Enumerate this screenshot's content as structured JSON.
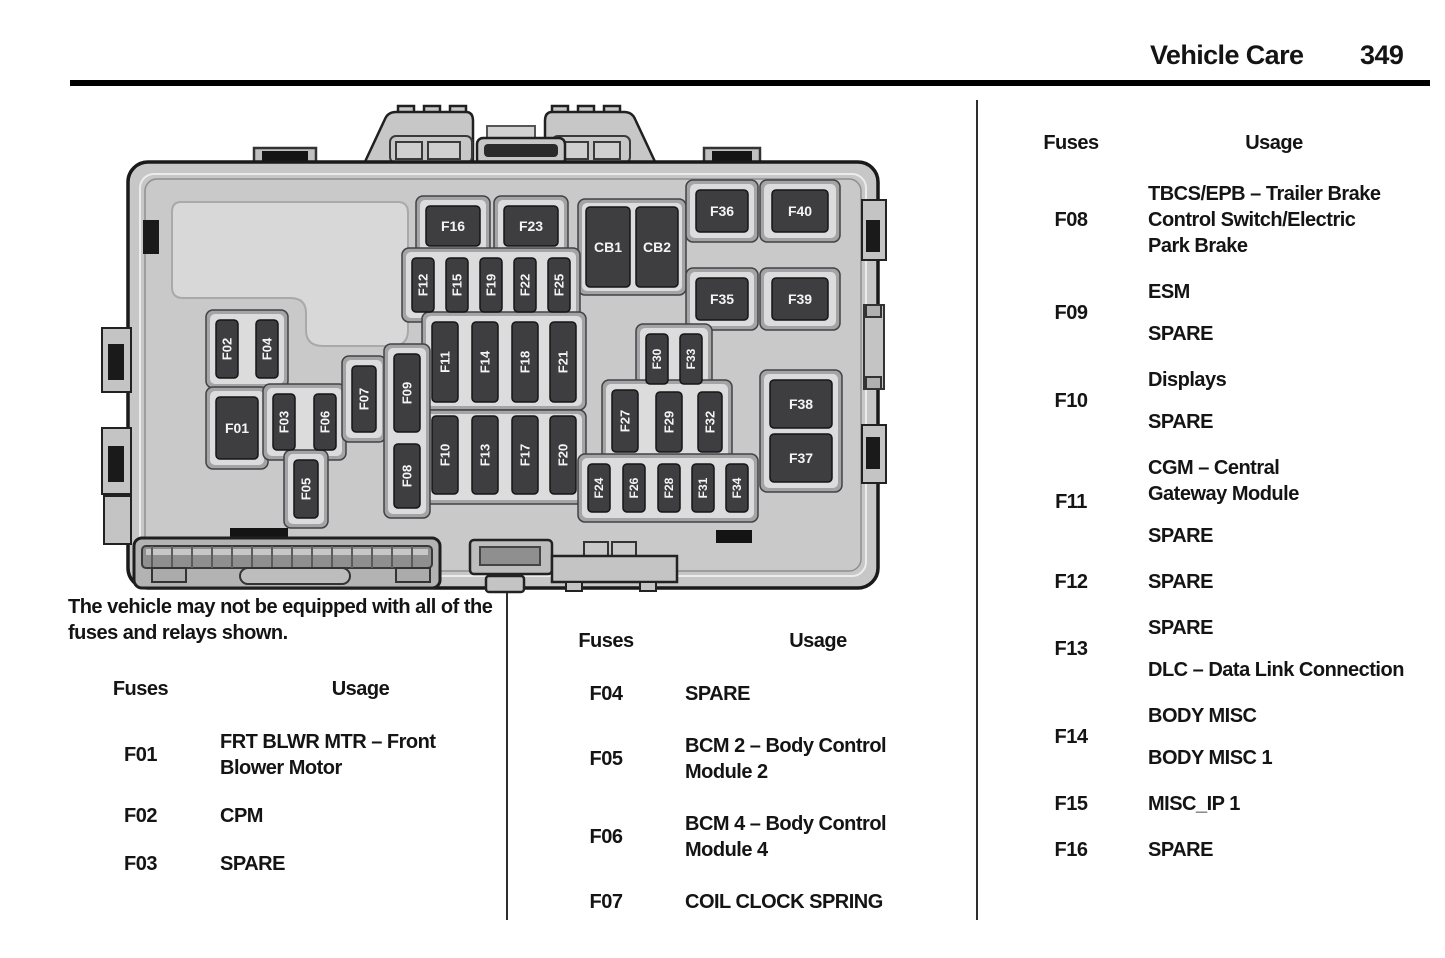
{
  "header": {
    "section_title": "Vehicle Care",
    "page_number": "349"
  },
  "note_lines": "The vehicle may not be equipped with all of the\nfuses and relays shown.",
  "tables": [
    {
      "headers": [
        "Fuses",
        "Usage"
      ],
      "rows": [
        {
          "fuse": "F01",
          "usage": [
            [
              "FRT BLWR MTR – Front",
              "Blower Motor"
            ]
          ]
        },
        {
          "fuse": "F02",
          "usage": [
            [
              "CPM"
            ]
          ]
        },
        {
          "fuse": "F03",
          "usage": [
            [
              "SPARE"
            ]
          ]
        }
      ]
    },
    {
      "headers": [
        "Fuses",
        "Usage"
      ],
      "rows": [
        {
          "fuse": "F04",
          "usage": [
            [
              "SPARE"
            ]
          ]
        },
        {
          "fuse": "F05",
          "usage": [
            [
              "BCM 2 – Body Control",
              "Module 2"
            ]
          ]
        },
        {
          "fuse": "F06",
          "usage": [
            [
              "BCM 4 – Body Control",
              "Module 4"
            ]
          ]
        },
        {
          "fuse": "F07",
          "usage": [
            [
              "COIL CLOCK SPRING"
            ]
          ]
        }
      ]
    },
    {
      "headers": [
        "Fuses",
        "Usage"
      ],
      "rows": [
        {
          "fuse": "F08",
          "usage": [
            [
              "TBCS/EPB – Trailer Brake",
              "Control Switch/Electric",
              "Park Brake"
            ]
          ]
        },
        {
          "fuse": "F09",
          "usage": [
            [
              "ESM"
            ],
            [
              "SPARE"
            ]
          ]
        },
        {
          "fuse": "F10",
          "usage": [
            [
              "Displays"
            ],
            [
              "SPARE"
            ]
          ]
        },
        {
          "fuse": "F11",
          "usage": [
            [
              "CGM – Central",
              "Gateway Module"
            ],
            [
              "SPARE"
            ]
          ]
        },
        {
          "fuse": "F12",
          "usage": [
            [
              "SPARE"
            ]
          ]
        },
        {
          "fuse": "F13",
          "usage": [
            [
              "SPARE"
            ],
            [
              "DLC – Data Link Connection"
            ]
          ]
        },
        {
          "fuse": "F14",
          "usage": [
            [
              "BODY MISC"
            ],
            [
              "BODY MISC 1"
            ]
          ]
        },
        {
          "fuse": "F15",
          "usage": [
            [
              "MISC_IP 1"
            ]
          ]
        },
        {
          "fuse": "F16",
          "usage": [
            [
              "SPARE"
            ]
          ]
        }
      ]
    }
  ],
  "diagram": {
    "colors": {
      "casing": "#c7c7c8",
      "casing_stroke": "#1a1a1a",
      "body": "#c9c9ca",
      "bright_panel": "#d8d8d9",
      "well_frame": "#a4a4a6",
      "well_frame_stroke": "#424244",
      "well_inner": "#dcdcdd",
      "fuse_fill": "#3e3e40",
      "fuse_stroke": "#151517",
      "fuse_text": "#f4f4f4",
      "tab_black": "#141414"
    },
    "wells": [
      [
        416,
        196,
        74,
        60
      ],
      [
        494,
        196,
        74,
        60
      ],
      [
        578,
        199,
        108,
        96
      ],
      [
        686,
        180,
        72,
        62
      ],
      [
        760,
        180,
        80,
        62
      ],
      [
        686,
        268,
        72,
        62
      ],
      [
        760,
        268,
        80,
        62
      ],
      [
        402,
        248,
        178,
        74
      ],
      [
        422,
        312,
        164,
        98
      ],
      [
        422,
        410,
        164,
        94
      ],
      [
        206,
        310,
        82,
        78
      ],
      [
        206,
        387,
        62,
        82
      ],
      [
        263,
        384,
        83,
        76
      ],
      [
        284,
        450,
        44,
        78
      ],
      [
        342,
        356,
        44,
        86
      ],
      [
        384,
        344,
        46,
        174
      ],
      [
        636,
        324,
        76,
        70
      ],
      [
        602,
        380,
        130,
        82
      ],
      [
        578,
        454,
        180,
        68
      ],
      [
        760,
        370,
        82,
        122
      ]
    ],
    "fuses": [
      {
        "id": "F01",
        "x": 216,
        "y": 397,
        "w": 42,
        "h": 62,
        "o": "h"
      },
      {
        "id": "F02",
        "x": 216,
        "y": 320,
        "w": 22,
        "h": 58,
        "o": "v"
      },
      {
        "id": "F04",
        "x": 256,
        "y": 320,
        "w": 22,
        "h": 58,
        "o": "v"
      },
      {
        "id": "F03",
        "x": 273,
        "y": 394,
        "w": 22,
        "h": 56,
        "o": "v"
      },
      {
        "id": "F06",
        "x": 314,
        "y": 394,
        "w": 22,
        "h": 56,
        "o": "v"
      },
      {
        "id": "F05",
        "x": 294,
        "y": 460,
        "w": 24,
        "h": 58,
        "o": "v"
      },
      {
        "id": "F07",
        "x": 352,
        "y": 366,
        "w": 24,
        "h": 66,
        "o": "v"
      },
      {
        "id": "F09",
        "x": 394,
        "y": 354,
        "w": 26,
        "h": 78,
        "o": "v"
      },
      {
        "id": "F08",
        "x": 394,
        "y": 444,
        "w": 26,
        "h": 64,
        "o": "v"
      },
      {
        "id": "F12",
        "x": 412,
        "y": 258,
        "w": 22,
        "h": 54,
        "o": "v"
      },
      {
        "id": "F15",
        "x": 446,
        "y": 258,
        "w": 22,
        "h": 54,
        "o": "v"
      },
      {
        "id": "F19",
        "x": 480,
        "y": 258,
        "w": 22,
        "h": 54,
        "o": "v"
      },
      {
        "id": "F22",
        "x": 514,
        "y": 258,
        "w": 22,
        "h": 54,
        "o": "v"
      },
      {
        "id": "F25",
        "x": 548,
        "y": 258,
        "w": 22,
        "h": 54,
        "o": "v"
      },
      {
        "id": "F16",
        "x": 426,
        "y": 206,
        "w": 54,
        "h": 40,
        "o": "h"
      },
      {
        "id": "F23",
        "x": 504,
        "y": 206,
        "w": 54,
        "h": 40,
        "o": "h"
      },
      {
        "id": "CB1",
        "x": 586,
        "y": 207,
        "w": 44,
        "h": 80,
        "o": "h"
      },
      {
        "id": "CB2",
        "x": 636,
        "y": 207,
        "w": 42,
        "h": 80,
        "o": "h"
      },
      {
        "id": "F36",
        "x": 696,
        "y": 190,
        "w": 52,
        "h": 42,
        "o": "h"
      },
      {
        "id": "F40",
        "x": 772,
        "y": 190,
        "w": 56,
        "h": 42,
        "o": "h"
      },
      {
        "id": "F35",
        "x": 696,
        "y": 278,
        "w": 52,
        "h": 42,
        "o": "h"
      },
      {
        "id": "F39",
        "x": 772,
        "y": 278,
        "w": 56,
        "h": 42,
        "o": "h"
      },
      {
        "id": "F11",
        "x": 432,
        "y": 322,
        "w": 26,
        "h": 80,
        "o": "v"
      },
      {
        "id": "F14",
        "x": 472,
        "y": 322,
        "w": 26,
        "h": 80,
        "o": "v"
      },
      {
        "id": "F18",
        "x": 512,
        "y": 322,
        "w": 26,
        "h": 80,
        "o": "v"
      },
      {
        "id": "F21",
        "x": 550,
        "y": 322,
        "w": 26,
        "h": 80,
        "o": "v"
      },
      {
        "id": "F10",
        "x": 432,
        "y": 416,
        "w": 26,
        "h": 78,
        "o": "v"
      },
      {
        "id": "F13",
        "x": 472,
        "y": 416,
        "w": 26,
        "h": 78,
        "o": "v"
      },
      {
        "id": "F17",
        "x": 512,
        "y": 416,
        "w": 26,
        "h": 78,
        "o": "v"
      },
      {
        "id": "F20",
        "x": 550,
        "y": 416,
        "w": 26,
        "h": 78,
        "o": "v"
      },
      {
        "id": "F30",
        "x": 646,
        "y": 334,
        "w": 22,
        "h": 50,
        "o": "v"
      },
      {
        "id": "F33",
        "x": 680,
        "y": 334,
        "w": 22,
        "h": 50,
        "o": "v"
      },
      {
        "id": "F27",
        "x": 612,
        "y": 390,
        "w": 26,
        "h": 62,
        "o": "v"
      },
      {
        "id": "F29",
        "x": 656,
        "y": 392,
        "w": 26,
        "h": 60,
        "o": "v"
      },
      {
        "id": "F32",
        "x": 698,
        "y": 392,
        "w": 24,
        "h": 60,
        "o": "v"
      },
      {
        "id": "F24",
        "x": 588,
        "y": 464,
        "w": 22,
        "h": 48,
        "o": "v"
      },
      {
        "id": "F26",
        "x": 623,
        "y": 464,
        "w": 22,
        "h": 48,
        "o": "v"
      },
      {
        "id": "F28",
        "x": 658,
        "y": 464,
        "w": 22,
        "h": 48,
        "o": "v"
      },
      {
        "id": "F31",
        "x": 692,
        "y": 464,
        "w": 22,
        "h": 48,
        "o": "v"
      },
      {
        "id": "F34",
        "x": 726,
        "y": 464,
        "w": 22,
        "h": 48,
        "o": "v"
      },
      {
        "id": "F38",
        "x": 770,
        "y": 380,
        "w": 62,
        "h": 48,
        "o": "h"
      },
      {
        "id": "F37",
        "x": 770,
        "y": 434,
        "w": 62,
        "h": 48,
        "o": "h"
      }
    ]
  }
}
